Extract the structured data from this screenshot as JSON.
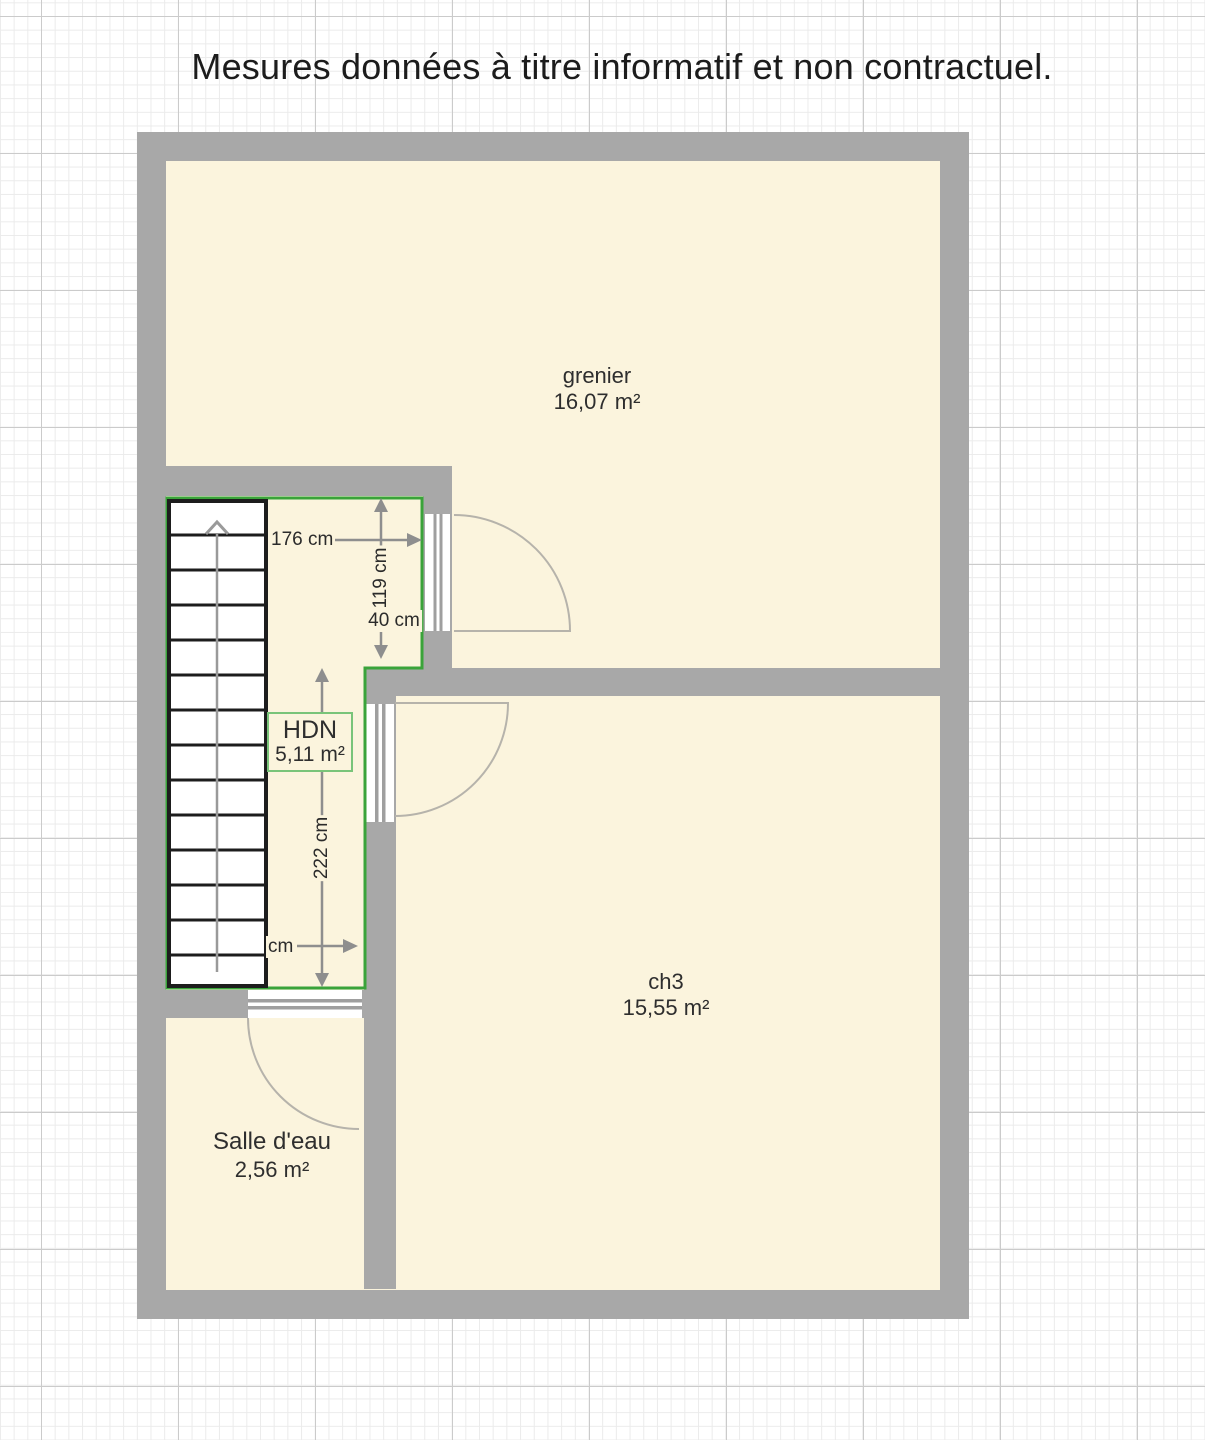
{
  "title": "Mesures données à titre informatif et non contractuel.",
  "plan": {
    "rooms": {
      "grenier": {
        "name": "grenier",
        "area": "16,07 m²"
      },
      "hdn": {
        "name": "HDN",
        "area": "5,11 m²"
      },
      "ch3": {
        "name": "ch3",
        "area": "15,55 m²"
      },
      "salle_deau": {
        "name": "Salle d'eau",
        "area": "2,56 m²"
      }
    },
    "dimensions": {
      "hdn_width": "176 cm",
      "hdn_upper_height": "119 cm",
      "hdn_offset": "40 cm",
      "hdn_lower_height": "222 cm",
      "hdn_bottom_width_partial": "cm"
    },
    "icons": {
      "stairs_direction": "up-arrow"
    },
    "colors": {
      "wall": "#a8a8a8",
      "floor": "#fbf4dd",
      "room_outline_green": "#3aa33a",
      "label_box_border": "#79c479",
      "dimension_gray": "#8e8e8e",
      "door_arc": "#b6b3ab",
      "grid_minor": "#ebebeb",
      "grid_major": "#cbcbcb",
      "stairs_stroke": "#1d1d1d"
    }
  }
}
